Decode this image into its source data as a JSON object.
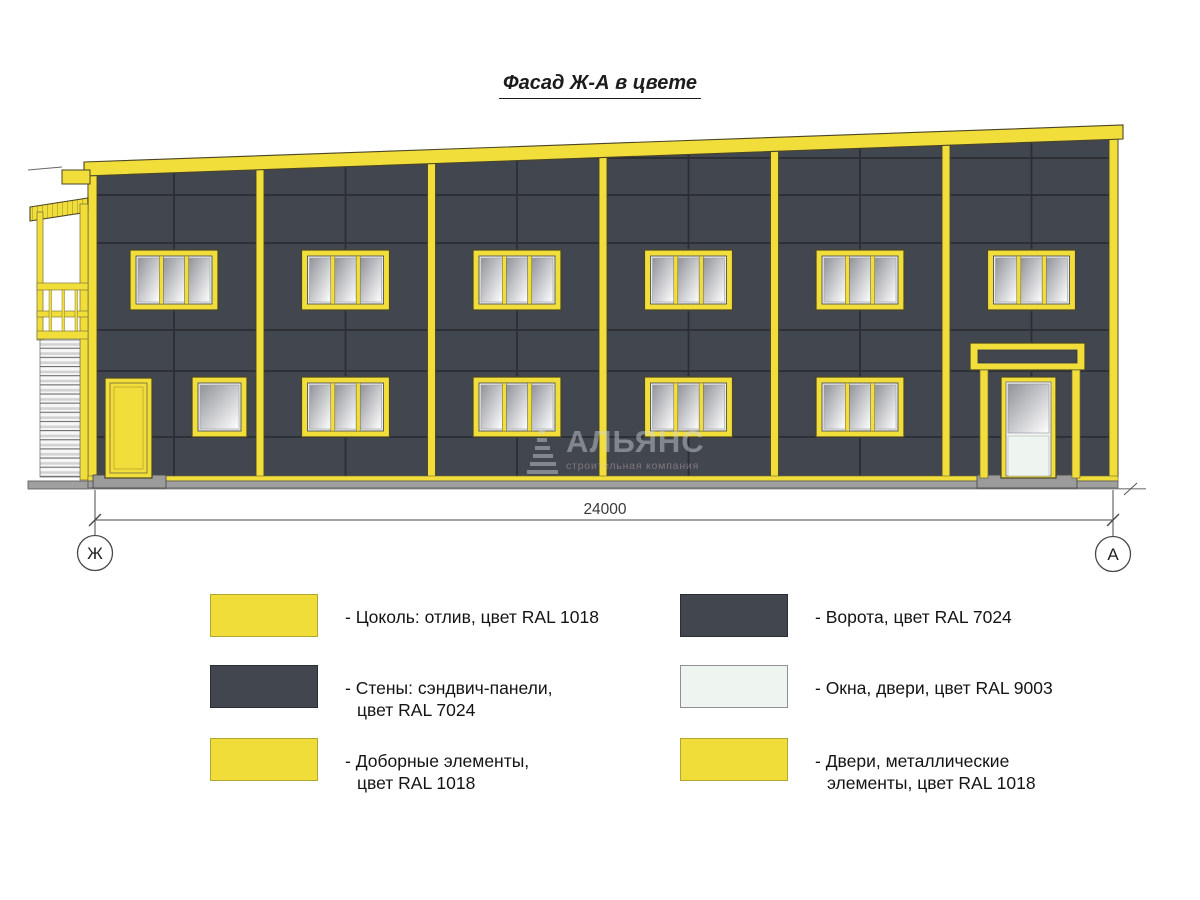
{
  "title": "Фасад Ж-А в цвете",
  "drawing": {
    "dimension_label": "24000",
    "axis_left": "Ж",
    "axis_right": "А",
    "watermark": {
      "name": "АЛЬЯНС",
      "subtitle": "строительная компания"
    }
  },
  "colors": {
    "ral_1018_yellow": "#f2de3b",
    "ral_7024_wall": "#42464e",
    "ral_9003_white": "#eef4ef",
    "panel_joint": "#2b2e34",
    "base_gray": "#a0a0a0"
  },
  "legend": {
    "items": [
      {
        "swatch_style": "background:#f0dd3a;border-color:#b2a531",
        "line1": "- Цоколь: отлив, цвет RAL 1018",
        "line2": ""
      },
      {
        "swatch_style": "background:#42464e;border-color:#2a2d33",
        "line1": "- Стены: сэндвич-панели,",
        "line2": "цвет RAL 7024"
      },
      {
        "swatch_style": "background:#f0dd3a;border-color:#b2a531",
        "line1": "- Доборные элементы,",
        "line2": "цвет RAL 1018"
      },
      {
        "swatch_style": "background:#42464e;border-color:#2a2d33",
        "line1": "- Ворота, цвет RAL 7024",
        "line2": ""
      },
      {
        "swatch_style": "background:#eef4ef;border-color:#8f8f8f",
        "line1": "- Окна, двери, цвет RAL 9003",
        "line2": ""
      },
      {
        "swatch_style": "background:#f0dd3a;border-color:#b2a531",
        "line1": "- Двери, металлические",
        "line2": "элементы, цвет RAL 1018"
      }
    ]
  }
}
